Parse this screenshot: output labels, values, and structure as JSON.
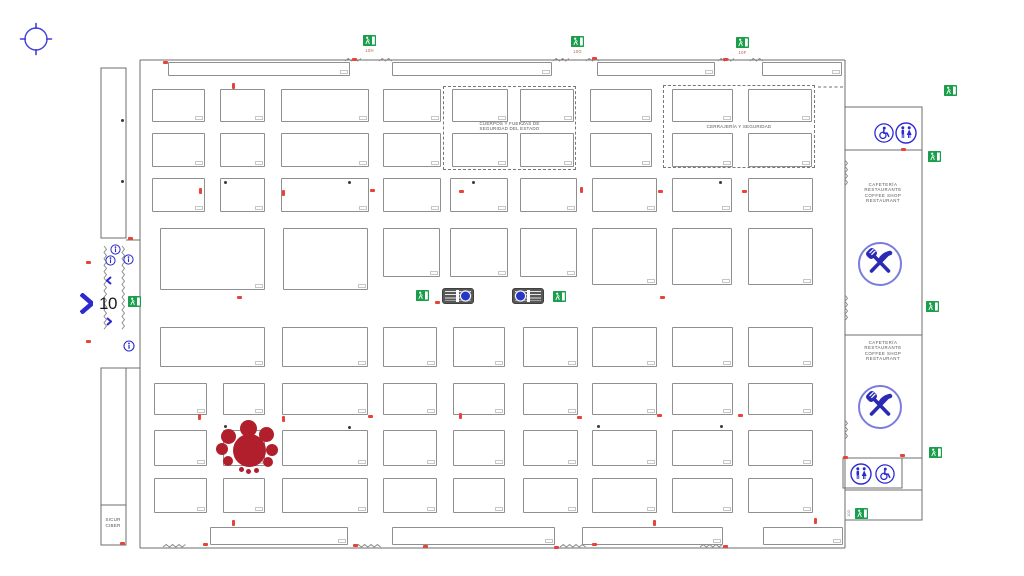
{
  "hall": {
    "number": "10"
  },
  "sicur_room": {
    "line1": "SICUR",
    "line2": "CIBER"
  },
  "cafeteria_lines": [
    "CAFETERÍA",
    "RESTAURANTE",
    "COFFEE SHOP",
    "RESTAURANT"
  ],
  "colors": {
    "wall": "#6e6e6e",
    "booth_border": "#8f8f8f",
    "exit_green": "#1a9e4b",
    "red_mark": "#e8433a",
    "cluster_red": "#b01f2b",
    "blue": "#2a2ad0",
    "circle_blue": "#7b7be0",
    "label_red": "#b9574e",
    "text_gray": "#555555"
  },
  "plan": {
    "booths": [
      [
        168,
        62,
        182,
        14
      ],
      [
        392,
        62,
        160,
        14
      ],
      [
        597,
        62,
        118,
        14
      ],
      [
        762,
        62,
        80,
        14
      ],
      [
        152,
        89,
        53,
        33
      ],
      [
        220,
        89,
        45,
        33
      ],
      [
        281,
        89,
        88,
        33
      ],
      [
        383,
        89,
        58,
        33
      ],
      [
        452,
        89,
        56,
        33
      ],
      [
        520,
        89,
        54,
        33
      ],
      [
        590,
        89,
        62,
        33
      ],
      [
        672,
        89,
        61,
        33
      ],
      [
        748,
        89,
        64,
        33
      ],
      [
        152,
        133,
        53,
        34
      ],
      [
        220,
        133,
        45,
        34
      ],
      [
        281,
        133,
        88,
        34
      ],
      [
        383,
        133,
        58,
        34
      ],
      [
        452,
        133,
        56,
        34
      ],
      [
        520,
        133,
        54,
        34
      ],
      [
        590,
        133,
        62,
        34
      ],
      [
        672,
        133,
        61,
        34
      ],
      [
        748,
        133,
        64,
        34
      ],
      [
        152,
        178,
        53,
        34
      ],
      [
        220,
        178,
        45,
        34
      ],
      [
        281,
        178,
        88,
        34
      ],
      [
        383,
        178,
        58,
        34
      ],
      [
        450,
        178,
        58,
        34
      ],
      [
        520,
        178,
        57,
        34
      ],
      [
        592,
        178,
        65,
        34
      ],
      [
        672,
        178,
        60,
        34
      ],
      [
        748,
        178,
        65,
        34
      ],
      [
        160,
        228,
        105,
        62
      ],
      [
        283,
        228,
        85,
        62
      ],
      [
        383,
        228,
        57,
        49
      ],
      [
        450,
        228,
        58,
        49
      ],
      [
        520,
        228,
        57,
        49
      ],
      [
        592,
        228,
        65,
        57
      ],
      [
        672,
        228,
        60,
        57
      ],
      [
        748,
        228,
        65,
        57
      ],
      [
        160,
        327,
        105,
        40
      ],
      [
        282,
        327,
        86,
        40
      ],
      [
        383,
        327,
        54,
        40
      ],
      [
        453,
        327,
        52,
        40
      ],
      [
        523,
        327,
        55,
        40
      ],
      [
        592,
        327,
        65,
        40
      ],
      [
        672,
        327,
        61,
        40
      ],
      [
        748,
        327,
        65,
        40
      ],
      [
        154,
        383,
        53,
        32
      ],
      [
        223,
        383,
        42,
        32
      ],
      [
        282,
        383,
        86,
        32
      ],
      [
        383,
        383,
        54,
        32
      ],
      [
        453,
        383,
        52,
        32
      ],
      [
        523,
        383,
        55,
        32
      ],
      [
        592,
        383,
        65,
        32
      ],
      [
        672,
        383,
        61,
        32
      ],
      [
        748,
        383,
        65,
        32
      ],
      [
        154,
        430,
        53,
        36
      ],
      [
        223,
        430,
        42,
        36
      ],
      [
        282,
        430,
        86,
        36
      ],
      [
        383,
        430,
        54,
        36
      ],
      [
        453,
        430,
        52,
        36
      ],
      [
        523,
        430,
        55,
        36
      ],
      [
        592,
        430,
        65,
        36
      ],
      [
        672,
        430,
        61,
        36
      ],
      [
        748,
        430,
        65,
        36
      ],
      [
        154,
        478,
        53,
        35
      ],
      [
        223,
        478,
        42,
        35
      ],
      [
        282,
        478,
        86,
        35
      ],
      [
        383,
        478,
        54,
        35
      ],
      [
        453,
        478,
        52,
        35
      ],
      [
        523,
        478,
        55,
        35
      ],
      [
        592,
        478,
        65,
        35
      ],
      [
        672,
        478,
        61,
        35
      ],
      [
        748,
        478,
        65,
        35
      ],
      [
        210,
        527,
        138,
        18
      ],
      [
        392,
        527,
        163,
        18
      ],
      [
        582,
        527,
        141,
        18
      ],
      [
        763,
        527,
        80,
        18
      ]
    ],
    "zones": [
      {
        "x": 443,
        "y": 86,
        "w": 133,
        "h": 84,
        "lines": [
          "CUERPOS Y FUERZAS DE",
          "SEGURIDAD DEL ESTADO"
        ],
        "ly": 121
      },
      {
        "x": 663,
        "y": 85,
        "w": 152,
        "h": 83,
        "lines": [
          "CERRAJERÍA Y SEGURIDAD"
        ],
        "ly": 124
      }
    ],
    "cafeterias": [
      {
        "x": 883,
        "y": 182
      },
      {
        "x": 883,
        "y": 340
      }
    ],
    "restaurant_icons": [
      {
        "cx": 880,
        "cy": 264,
        "r": 23
      },
      {
        "cx": 880,
        "cy": 407,
        "r": 23
      }
    ],
    "amenity_icons": [
      {
        "type": "wheelchair",
        "cx": 884,
        "cy": 133,
        "r": 10
      },
      {
        "type": "wc",
        "cx": 906,
        "cy": 133,
        "r": 11
      },
      {
        "type": "wc",
        "cx": 861,
        "cy": 474,
        "r": 11
      },
      {
        "type": "wheelchair",
        "cx": 885,
        "cy": 474,
        "r": 10
      },
      {
        "type": "info",
        "cx": 115,
        "cy": 249,
        "r": 5.5
      },
      {
        "type": "info",
        "cx": 110,
        "cy": 260,
        "r": 5.5
      },
      {
        "type": "info",
        "cx": 128,
        "cy": 259,
        "r": 5.5
      },
      {
        "type": "info",
        "cx": 129,
        "cy": 346,
        "r": 6
      }
    ],
    "exits": [
      {
        "x": 363,
        "y": 35,
        "label": "10H"
      },
      {
        "x": 571,
        "y": 36,
        "label": "10G"
      },
      {
        "x": 736,
        "y": 37,
        "label": "10F"
      },
      {
        "x": 944,
        "y": 85
      },
      {
        "x": 928,
        "y": 151
      },
      {
        "x": 926,
        "y": 301
      },
      {
        "x": 929,
        "y": 447
      },
      {
        "x": 855,
        "y": 508
      },
      {
        "x": 128,
        "y": 296
      },
      {
        "x": 416,
        "y": 290
      },
      {
        "x": 553,
        "y": 291
      }
    ],
    "stairs": [
      {
        "x": 442,
        "y": 288,
        "w": 32,
        "h": 16,
        "circle": "right"
      },
      {
        "x": 512,
        "y": 288,
        "w": 32,
        "h": 16,
        "circle": "left"
      }
    ],
    "cluster": [
      [
        249,
        450,
        16.5
      ],
      [
        248,
        428,
        8.5
      ],
      [
        266,
        434,
        7.5
      ],
      [
        272,
        450,
        6
      ],
      [
        268,
        462,
        5
      ],
      [
        228,
        436,
        7.5
      ],
      [
        222,
        449,
        6
      ],
      [
        228,
        461,
        5
      ],
      [
        241,
        469,
        2.5
      ],
      [
        248,
        471,
        2.5
      ],
      [
        256,
        470,
        2.5
      ]
    ],
    "red_marks": [
      [
        163,
        61
      ],
      [
        352,
        58
      ],
      [
        592,
        57
      ],
      [
        723,
        58
      ],
      [
        232,
        83,
        "v"
      ],
      [
        199,
        188,
        "v"
      ],
      [
        282,
        190,
        "v"
      ],
      [
        370,
        189
      ],
      [
        459,
        190
      ],
      [
        580,
        187,
        "v"
      ],
      [
        658,
        190
      ],
      [
        742,
        190
      ],
      [
        86,
        261
      ],
      [
        86,
        340
      ],
      [
        128,
        237
      ],
      [
        237,
        296
      ],
      [
        435,
        301
      ],
      [
        660,
        296
      ],
      [
        198,
        414,
        "v"
      ],
      [
        282,
        416,
        "v"
      ],
      [
        368,
        415
      ],
      [
        459,
        413,
        "v"
      ],
      [
        577,
        416
      ],
      [
        657,
        414
      ],
      [
        738,
        414
      ],
      [
        232,
        520,
        "v"
      ],
      [
        653,
        520,
        "v"
      ],
      [
        814,
        518,
        "v"
      ],
      [
        203,
        543
      ],
      [
        353,
        544
      ],
      [
        423,
        545
      ],
      [
        554,
        546
      ],
      [
        592,
        543
      ],
      [
        723,
        545
      ],
      [
        901,
        148
      ],
      [
        900,
        454
      ],
      [
        843,
        456
      ],
      [
        120,
        542
      ]
    ],
    "pillars": [
      [
        224,
        181
      ],
      [
        348,
        181
      ],
      [
        472,
        181
      ],
      [
        719,
        181
      ],
      [
        224,
        425
      ],
      [
        348,
        426
      ],
      [
        597,
        425
      ],
      [
        720,
        425
      ],
      [
        121,
        119
      ],
      [
        121,
        180
      ]
    ],
    "texts": [
      {
        "x": 849,
        "y": 511,
        "lines": [
          "10D"
        ],
        "size": 4,
        "color": "#888",
        "rotate": -90,
        "lh": 4.5
      }
    ],
    "chevrons": [
      {
        "x": 80,
        "y": 293,
        "w": 13,
        "h": 21,
        "dir": "r",
        "sw": 4.5
      },
      {
        "x": 106,
        "y": 276,
        "w": 6,
        "h": 9,
        "dir": "l",
        "sw": 2
      },
      {
        "x": 106,
        "y": 317,
        "w": 6,
        "h": 9,
        "dir": "r",
        "sw": 2
      }
    ],
    "zigzags": [
      [
        345,
        61,
        18,
        "h"
      ],
      [
        379,
        61,
        14,
        "h"
      ],
      [
        553,
        61,
        16,
        "h"
      ],
      [
        586,
        61,
        14,
        "h"
      ],
      [
        718,
        61,
        16,
        "h"
      ],
      [
        750,
        61,
        14,
        "h"
      ],
      [
        355,
        547,
        28,
        "h"
      ],
      [
        560,
        547,
        28,
        "h"
      ],
      [
        163,
        547,
        25,
        "h"
      ],
      [
        700,
        547,
        25,
        "h"
      ],
      [
        104,
        246,
        86,
        "v"
      ],
      [
        122,
        246,
        86,
        "v"
      ],
      [
        845,
        160,
        28,
        "v"
      ],
      [
        845,
        295,
        28,
        "v"
      ],
      [
        845,
        420,
        20,
        "v"
      ]
    ]
  }
}
